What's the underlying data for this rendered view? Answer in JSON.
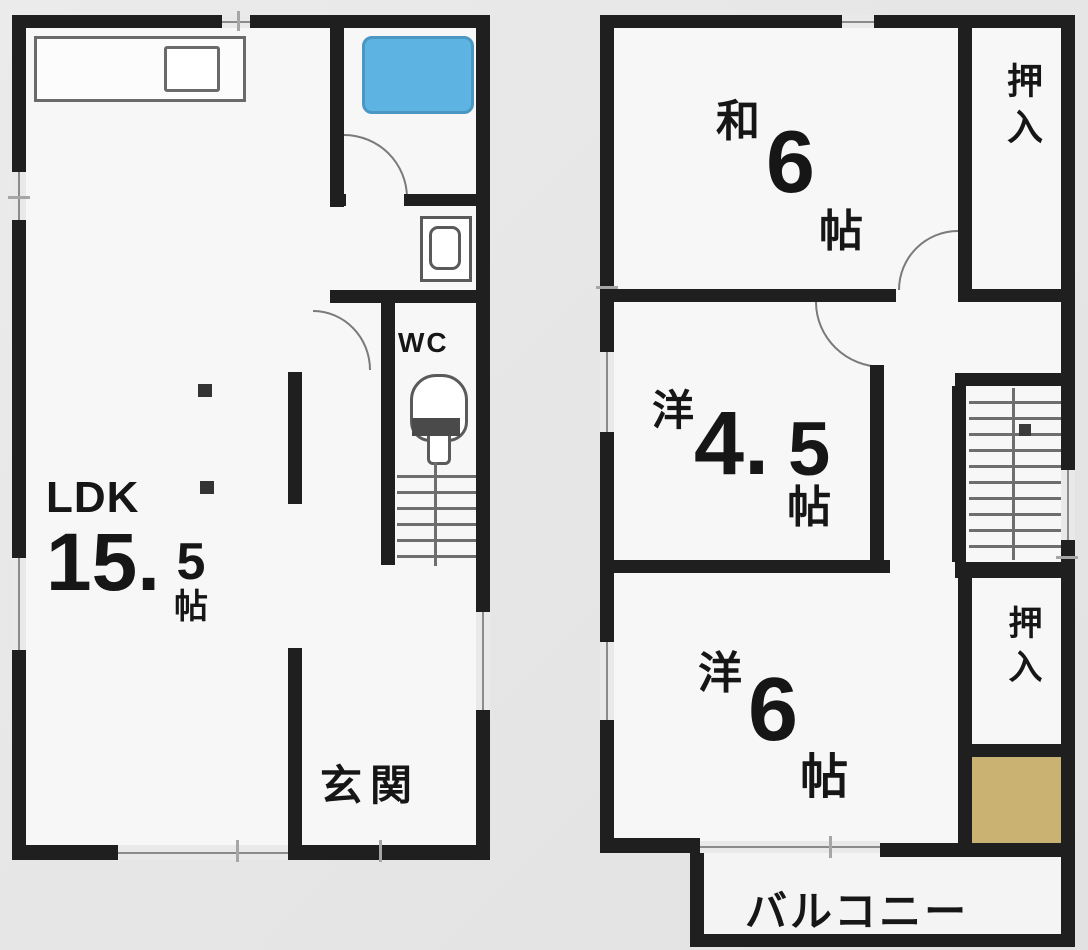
{
  "floor1": {
    "ldk": {
      "name": "LDK",
      "size_main": "15.",
      "size_sub": "5",
      "unit": "帖"
    },
    "wc_label": "WC",
    "genkan_label": "玄関"
  },
  "floor2": {
    "washitsu": {
      "prefix": "和",
      "size": "6",
      "unit": "帖"
    },
    "youshitsu_45": {
      "prefix": "洋",
      "size_main": "4.",
      "size_sub": "5",
      "unit": "帖"
    },
    "youshitsu_6": {
      "prefix": "洋",
      "size": "6",
      "unit": "帖"
    },
    "oshiire_top": "押入",
    "oshiire_bottom": "押入",
    "balcony": "バルコニー"
  },
  "colors": {
    "wall": "#1f1f1f",
    "bathtub_fill": "#5db3e2",
    "bathtub_border": "#4b97c4",
    "storage_tan": "#c9b272",
    "room_fill": "#f7f7f7",
    "background": "#e7e7e7"
  }
}
